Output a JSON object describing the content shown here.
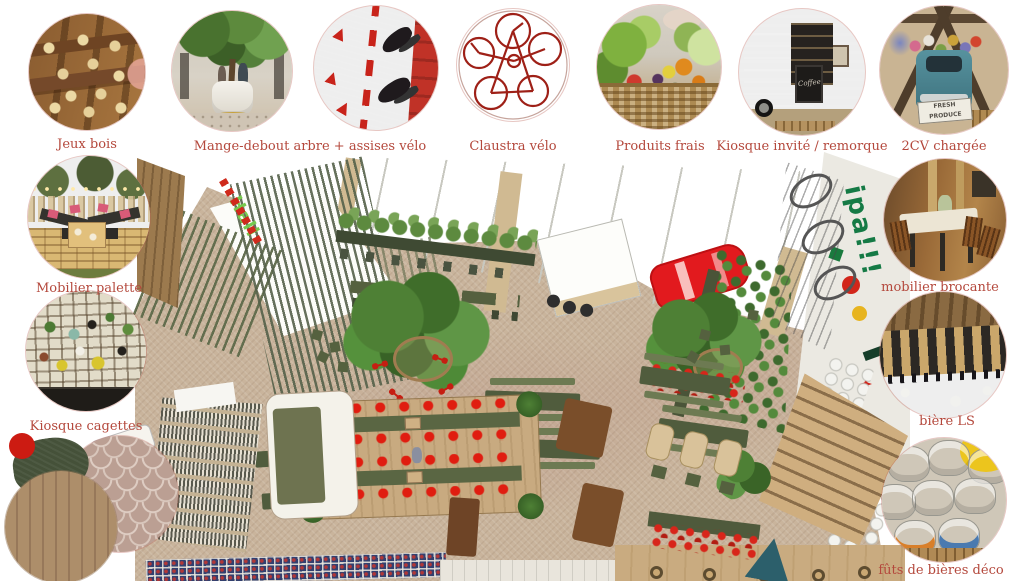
{
  "page": {
    "background": "#ffffff",
    "label_color": "#b4483c",
    "accent_red": "#d2261a",
    "olive_green": "#505c3d",
    "floor_tan": "#c9b49c"
  },
  "callouts": {
    "top": [
      {
        "id": "jeux-bois",
        "label": "Jeux bois"
      },
      {
        "id": "mange-debout-arbre",
        "label": "Mange-debout arbre + assises vélo"
      },
      {
        "id": "assises-velo",
        "label": ""
      },
      {
        "id": "claustra-velo",
        "label": "Claustra vélo"
      },
      {
        "id": "produits-frais",
        "label": "Produits frais"
      },
      {
        "id": "kiosque-invite",
        "label": "Kiosque invité / remorque",
        "sign_text": "Coffee"
      },
      {
        "id": "2cv-chargee",
        "label": "2CV chargée",
        "sign_text": "FRESH PRODUCE"
      }
    ],
    "left": [
      {
        "id": "mobilier-palette",
        "label": "Mobilier palette"
      },
      {
        "id": "kiosque-cagettes",
        "label": "Kiosque cagettes"
      }
    ],
    "right": [
      {
        "id": "mobilier-brocante",
        "label": "mobilier brocante"
      },
      {
        "id": "biere-ls",
        "label": "bière LS"
      },
      {
        "id": "futs-de-bieres",
        "label": "fûts de bières déco"
      }
    ],
    "swatches": [
      {
        "id": "red-paint"
      },
      {
        "id": "dark-green-fabric"
      },
      {
        "id": "scallop-tile"
      },
      {
        "id": "wood-planks"
      }
    ]
  },
  "plan": {
    "floor_text": "Hall",
    "mural_text": "ipa!!!"
  }
}
